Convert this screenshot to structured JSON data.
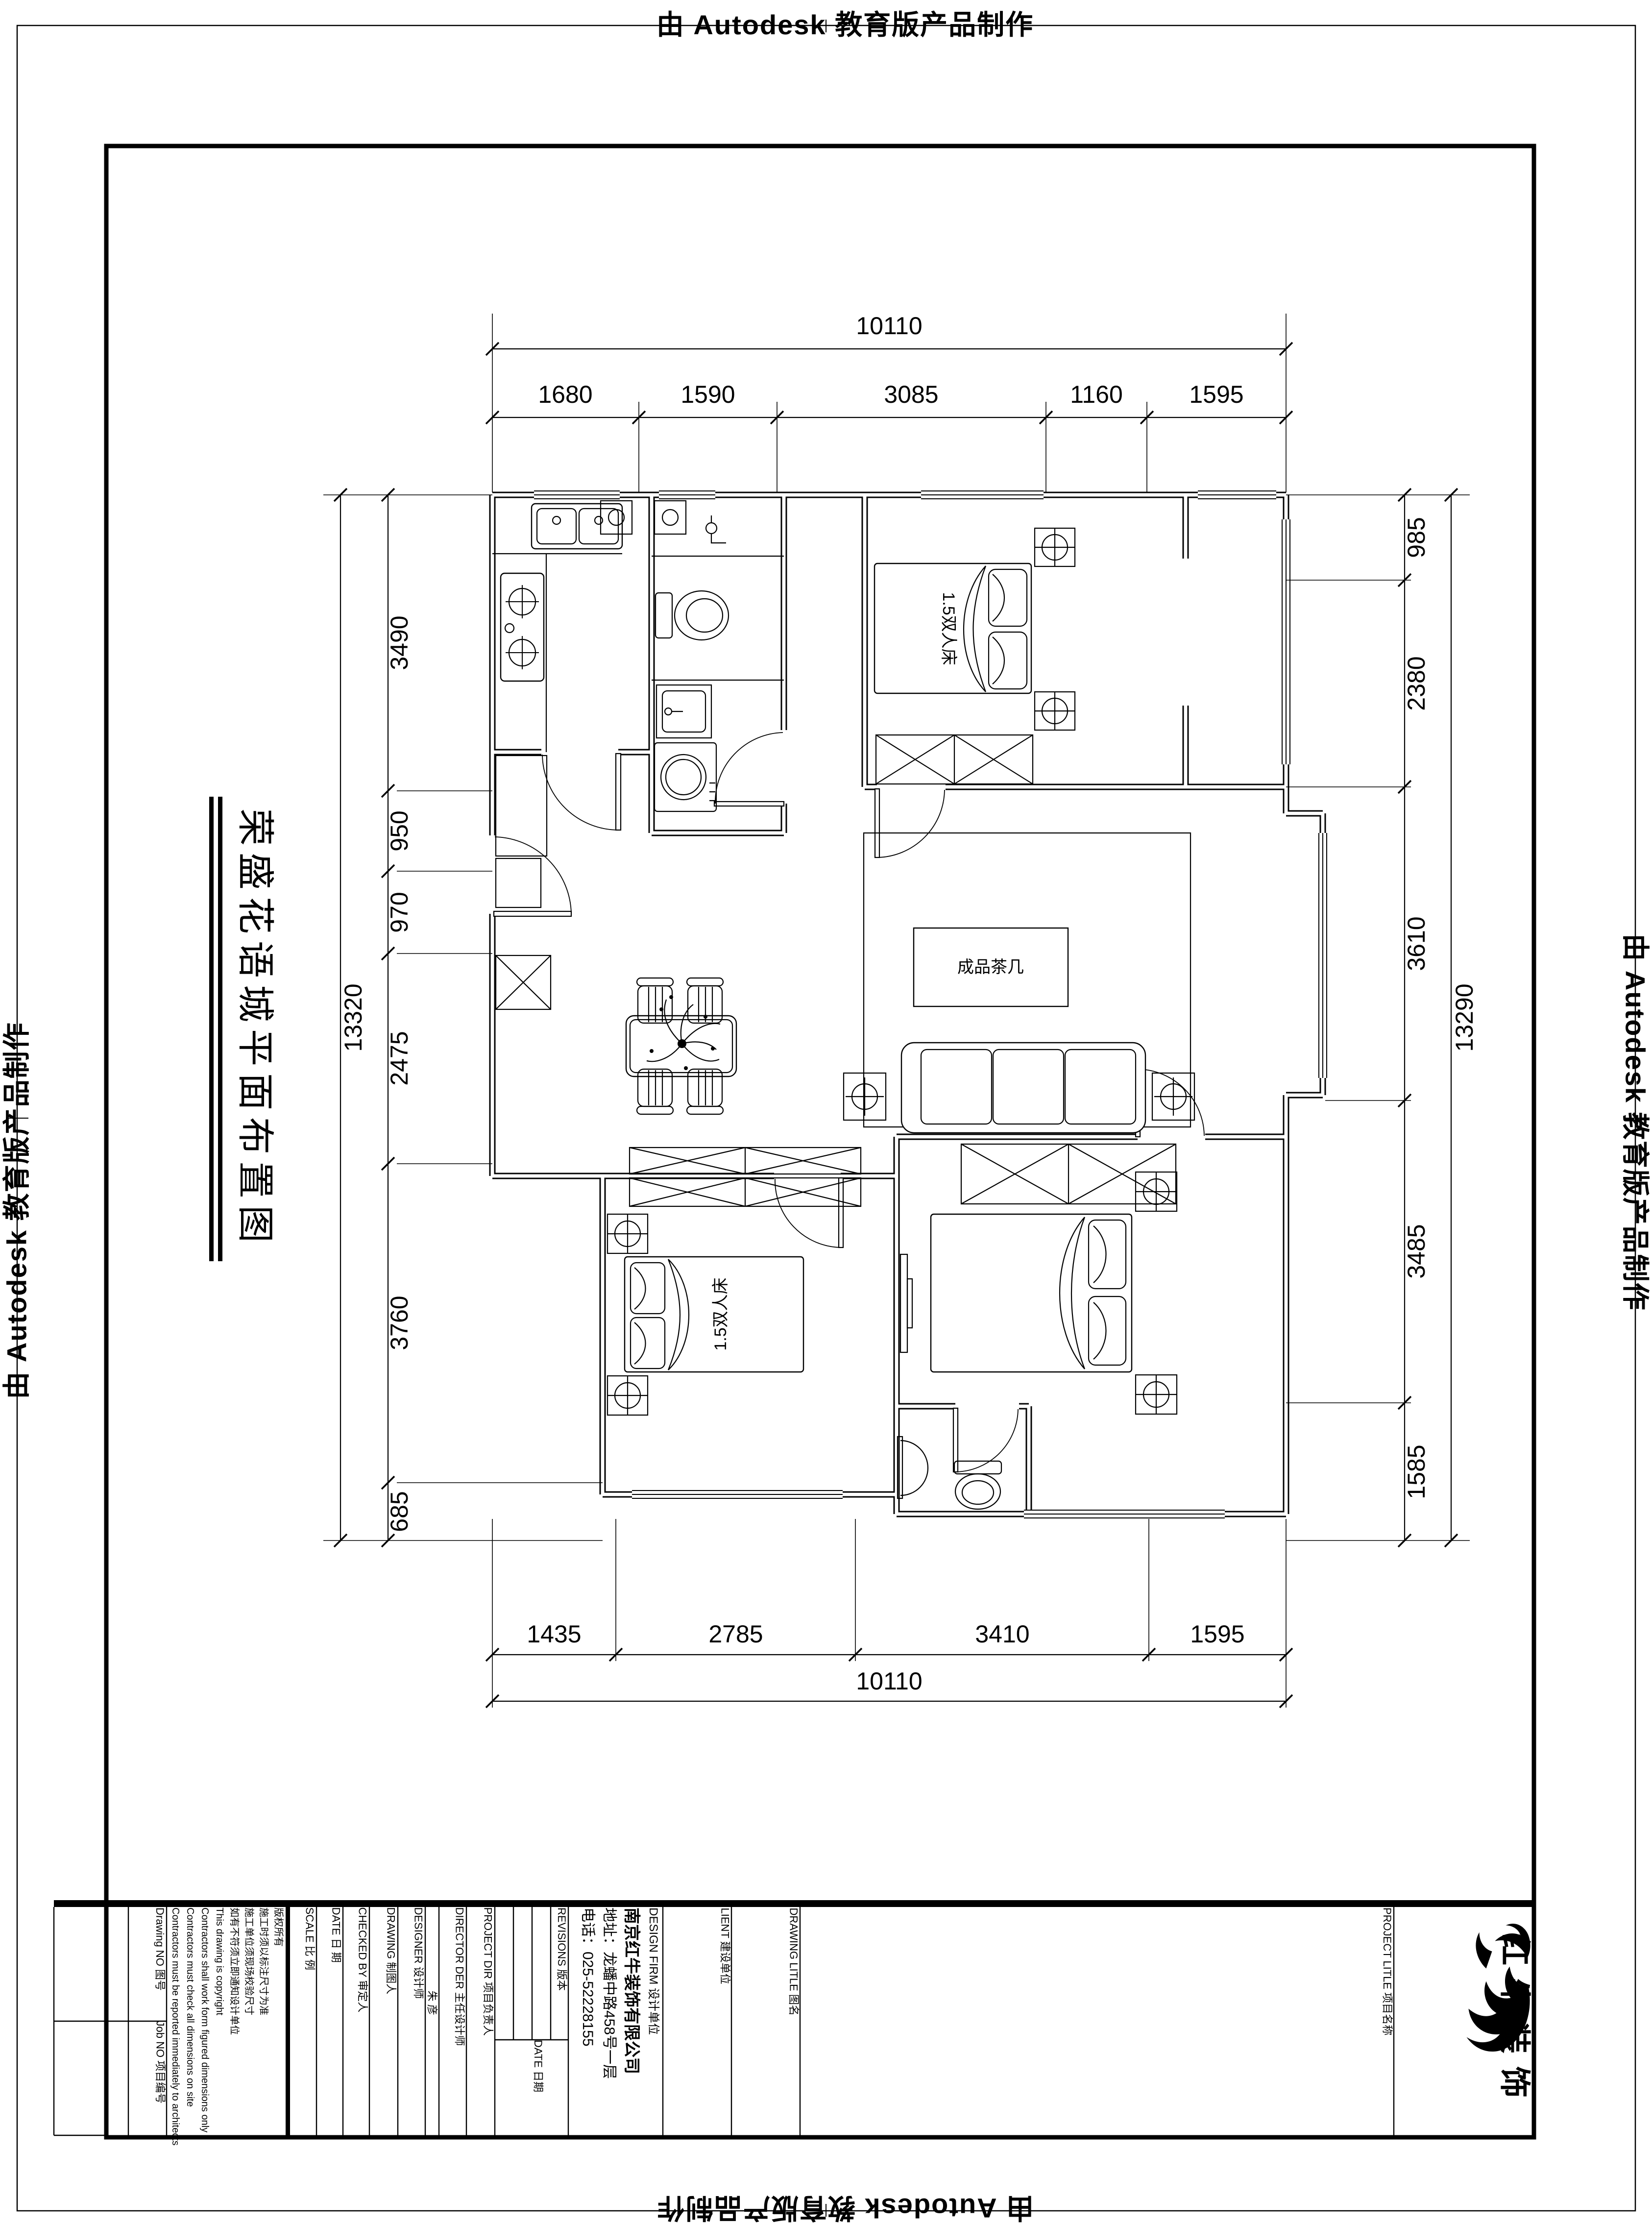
{
  "stamp": {
    "text": "由 Autodesk 教育版产品制作"
  },
  "title": {
    "text": "荣盛花语城平面布置图"
  },
  "dimensions": {
    "top_total": "10110",
    "top": [
      "1680",
      "1590",
      "3085",
      "1160",
      "1595"
    ],
    "bottom": [
      "1435",
      "2785",
      "3410",
      "1595"
    ],
    "bottom_total": "10110",
    "left": [
      "3490",
      "950",
      "970",
      "2475",
      "3760",
      "685"
    ],
    "left_total": "13320",
    "right": [
      "985",
      "2380",
      "3610",
      "3485",
      "1585"
    ],
    "right_total": "13290"
  },
  "plan_labels": {
    "bedroom1_bed": "1.5双人床",
    "bedroom2_bed": "1.5双人床",
    "coffee_table": "成品茶几"
  },
  "title_block": {
    "drawing_no": "Drawing NO 图号",
    "job_no": "Job NO 项目编号",
    "notes": [
      "版权所有",
      "施工时须以标注尺寸为准",
      "施工单位须现场校验尺寸",
      "如有不符须立即通知设计单位",
      "This drawing is copyright",
      "Contractors shall work form figured dimensions only",
      "Contractors must check all dimensions on site",
      "Contractors must be reported immediately to architects"
    ],
    "scale": "SCALE        比  例",
    "date": "DATE        日  期",
    "checked_by": "CHECKED BY   审定人",
    "drawing_by": "DRAWING      制图人",
    "designer": "DESIGNER     设计师",
    "director_name": "朱 彦",
    "director": "DIRECTOR DER 主任设计师",
    "project_dir": "PROJECT DIR   项目负责人",
    "revisions": "REVISIONS  版本",
    "rev_date": "DATE 日期",
    "design_firm_label": "DESIGN FIRM  设计单位",
    "firm_name": "南京红牛装饰有限公司",
    "firm_address": "地址：龙蟠中路458号一层",
    "firm_phone": "电话：025-52228155",
    "client": "LIENT  建设单位",
    "drawing_title": "DRAWING LITLE  图名",
    "project_title": "PROJECT LITLE  项目名称",
    "logo_text": "红牛装饰"
  }
}
